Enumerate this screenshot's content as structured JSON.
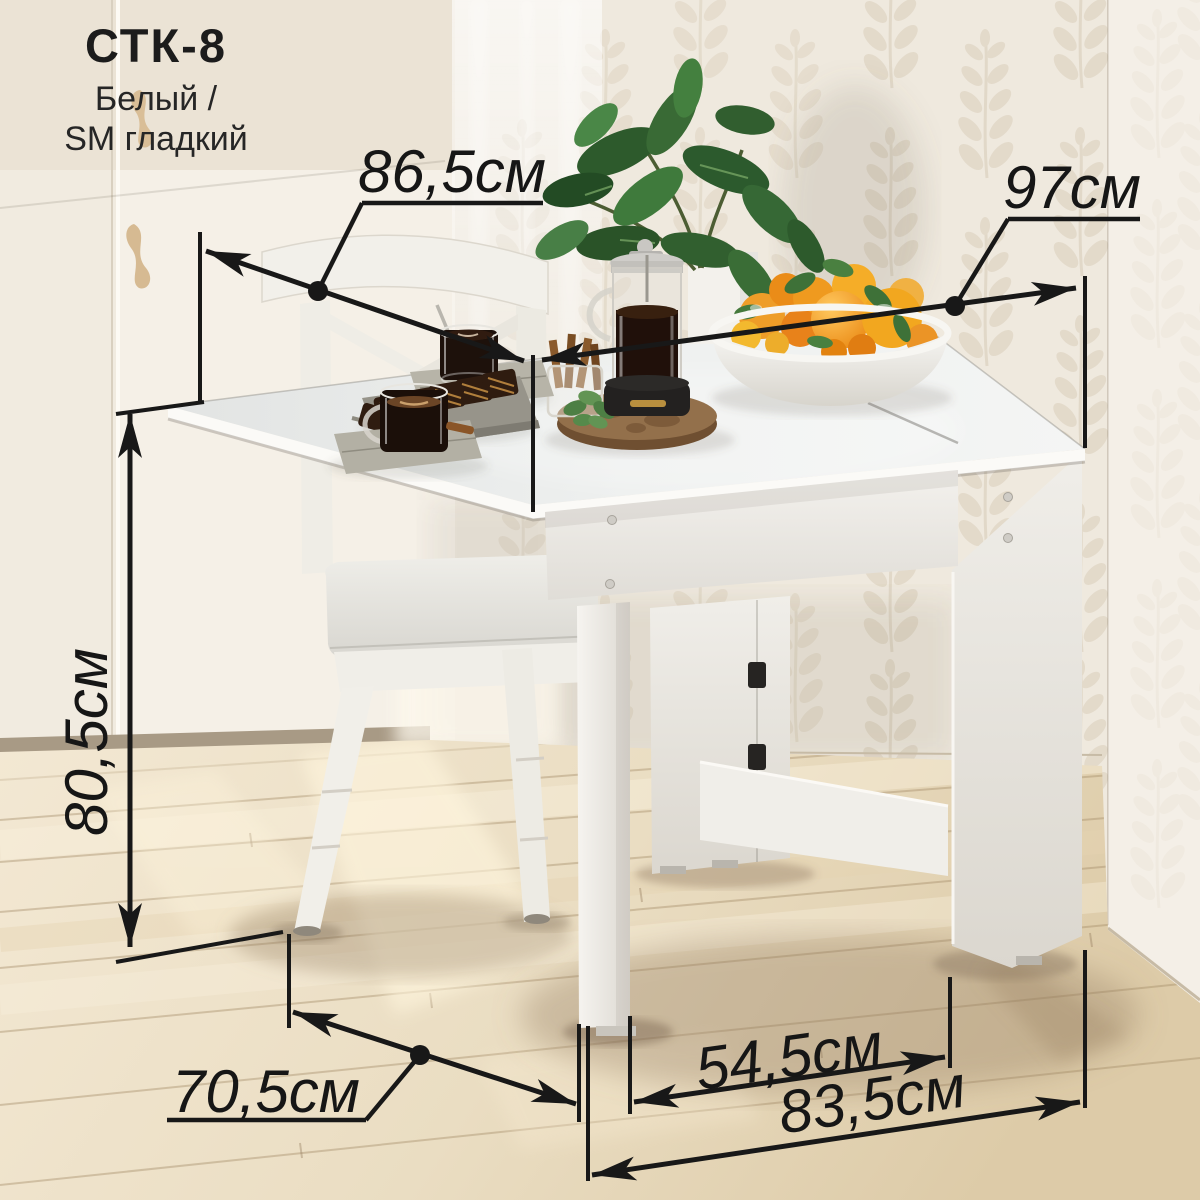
{
  "product": {
    "model": "СТК-8",
    "finish": {
      "line1": "Белый /",
      "line2": "SM гладкий"
    }
  },
  "dimensions": {
    "tabletop_depth": {
      "label": "86,5см"
    },
    "tabletop_width": {
      "label": "97см"
    },
    "height": {
      "label": "80,5см"
    },
    "base_depth": {
      "label": "70,5см"
    },
    "leg_clearance_width": {
      "label": "54,5см"
    },
    "base_width": {
      "label": "83,5см"
    }
  },
  "style": {
    "dimension_line_color": "#181818",
    "label_color": "#161616",
    "wall_color": "#efe9de",
    "floor_color": "#ecdfc6",
    "furniture_color": "#f2f1ee"
  }
}
